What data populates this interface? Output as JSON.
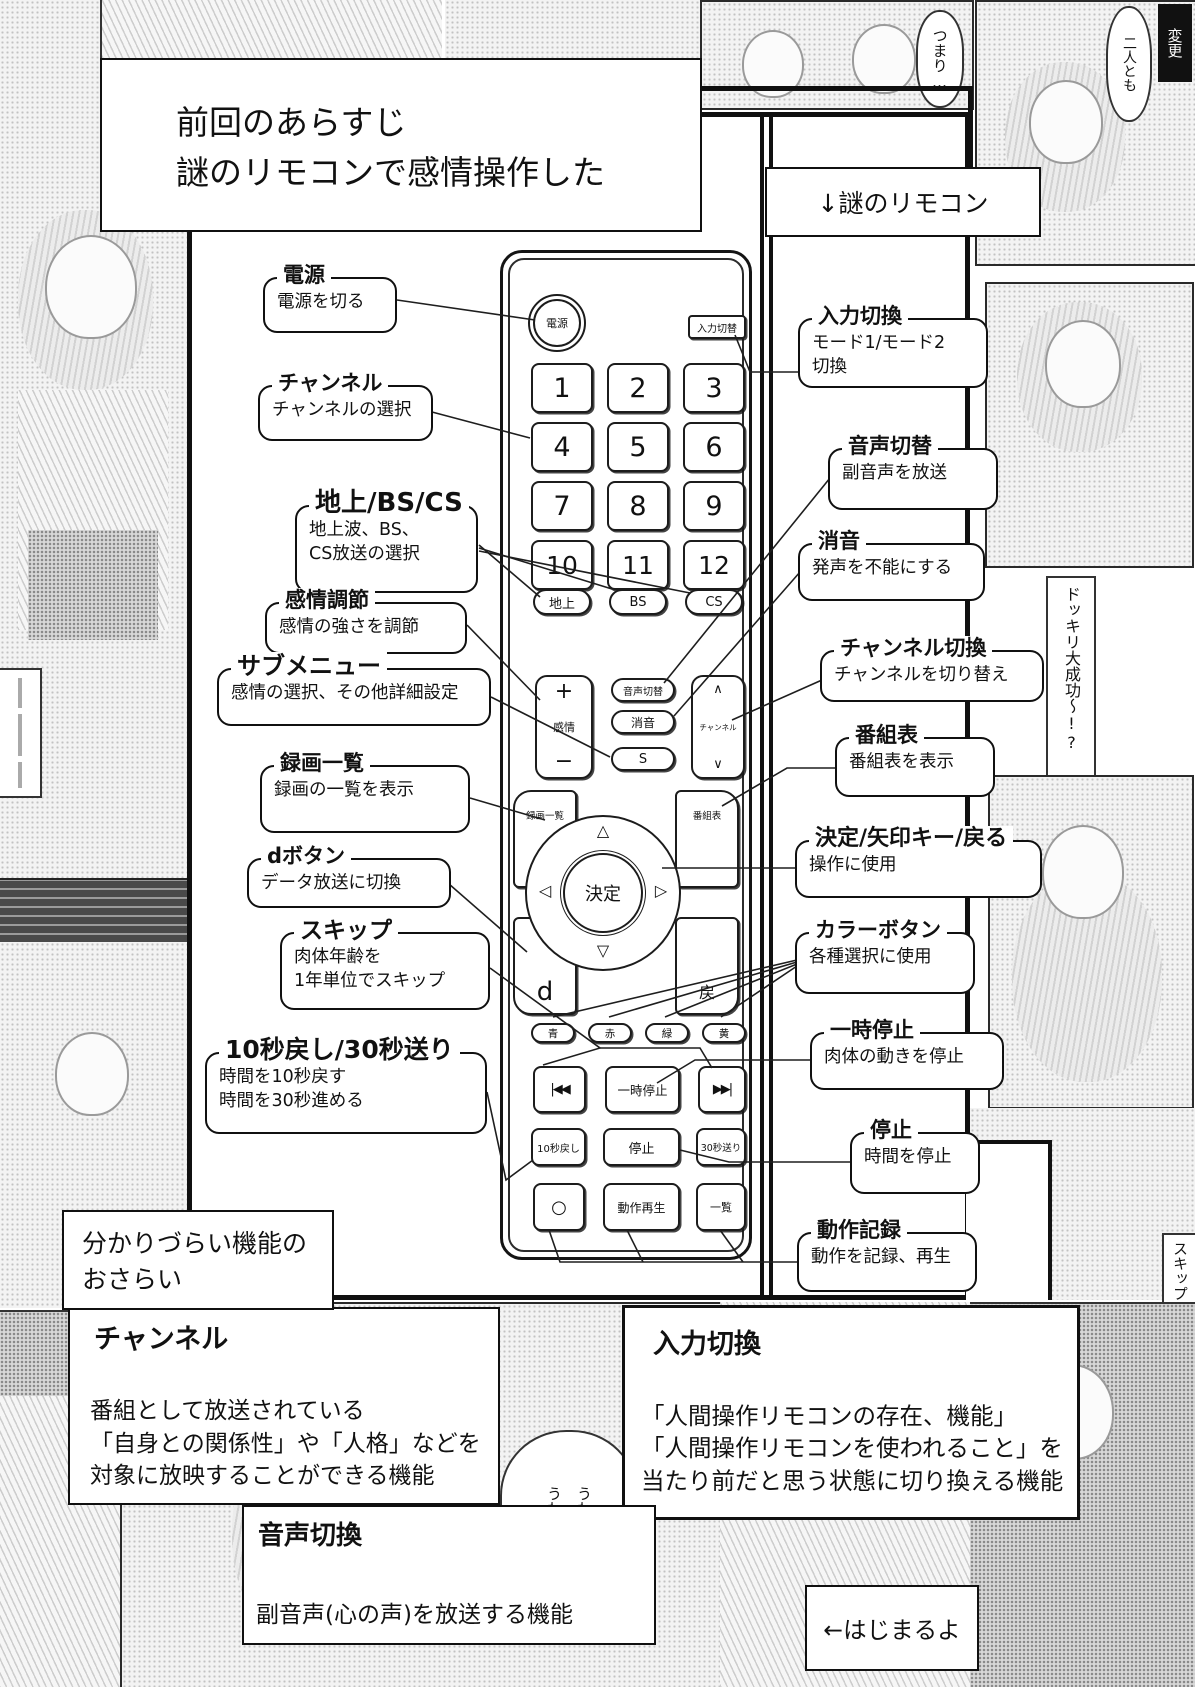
{
  "page": {
    "recap": "前回のあらすじ\n謎のリモコンで感情操作した",
    "pointer": "↓謎のリモコン",
    "start": "←はじまるよ"
  },
  "remote": {
    "power": "電源",
    "input": "入力切替",
    "numbers": [
      "1",
      "2",
      "3",
      "4",
      "5",
      "6",
      "7",
      "8",
      "9",
      "10",
      "11",
      "12"
    ],
    "bands": [
      "地上",
      "BS",
      "CS"
    ],
    "audio": "音声切替",
    "mute": "消音",
    "sub": "S",
    "emotion": {
      "plus": "+",
      "label": "感情",
      "minus": "−"
    },
    "channel": {
      "up": "∧",
      "label": "チャンネル",
      "down": "∨"
    },
    "nav": {
      "rec": "録画一覧",
      "guide": "番組表",
      "ok": "決定",
      "d": "d",
      "back": "戻",
      "up": "△",
      "down": "▽",
      "left": "◁",
      "right": "▷"
    },
    "colors": [
      "青",
      "赤",
      "緑",
      "黄"
    ],
    "transport": [
      "|◀◀",
      "一時停止",
      "▶▶|"
    ],
    "time": [
      "10秒戻し",
      "停止",
      "30秒送り"
    ],
    "bottom": [
      "○",
      "動作再生",
      "一覧"
    ]
  },
  "callouts_left": [
    {
      "title": "電源",
      "desc": "電源を切る"
    },
    {
      "title": "チャンネル",
      "desc": "チャンネルの選択"
    },
    {
      "title": "地上/BS/CS",
      "desc": "地上波、BS、\nCS放送の選択"
    },
    {
      "title": "感情調節",
      "desc": "感情の強さを調節"
    },
    {
      "title": "サブメニュー",
      "desc": "感情の選択、その他詳細設定"
    },
    {
      "title": "録画一覧",
      "desc": "録画の一覧を表示"
    },
    {
      "title": "dボタン",
      "desc": "データ放送に切換"
    },
    {
      "title": "スキップ",
      "desc": "肉体年齢を\n1年単位でスキップ"
    },
    {
      "title": "10秒戻し/30秒送り",
      "desc": "時間を10秒戻す\n時間を30秒進める"
    }
  ],
  "callouts_right": [
    {
      "title": "入力切換",
      "desc": "モード1/モード2\n切換"
    },
    {
      "title": "音声切替",
      "desc": "副音声を放送"
    },
    {
      "title": "消音",
      "desc": "発声を不能にする"
    },
    {
      "title": "チャンネル切換",
      "desc": "チャンネルを切り替え"
    },
    {
      "title": "番組表",
      "desc": "番組表を表示"
    },
    {
      "title": "決定/矢印キー/戻る",
      "desc": "操作に使用"
    },
    {
      "title": "カラーボタン",
      "desc": "各種選択に使用"
    },
    {
      "title": "一時停止",
      "desc": "肉体の動きを停止"
    },
    {
      "title": "停止",
      "desc": "時間を停止"
    },
    {
      "title": "動作記録",
      "desc": "動作を記録、再生"
    }
  ],
  "review": {
    "intro": "分かりづらい機能の\nおさらい",
    "sections": [
      {
        "title": "チャンネル",
        "body": "番組として放送されている\n「自身との関係性」や「人格」などを\n対象に放映することができる機能"
      },
      {
        "title": "入力切換",
        "body": "「人間操作リモコンの存在、機能」\n「人間操作リモコンを使われること」を\n当たり前だと思う状態に切り換える機能"
      },
      {
        "title": "音声切換",
        "body": "副音声(心の声)を放送する機能"
      }
    ]
  },
  "background": {
    "title_fragment": "モコン",
    "bubble_top": "つまり…",
    "bubble_top_right": "二人とも",
    "tag_top_right": "変更",
    "vtext_right": "ドッキリ大成功〜!?",
    "vtext_right_lower": "スキップ",
    "bubble_bottom": "うわっ\nうわっ"
  }
}
